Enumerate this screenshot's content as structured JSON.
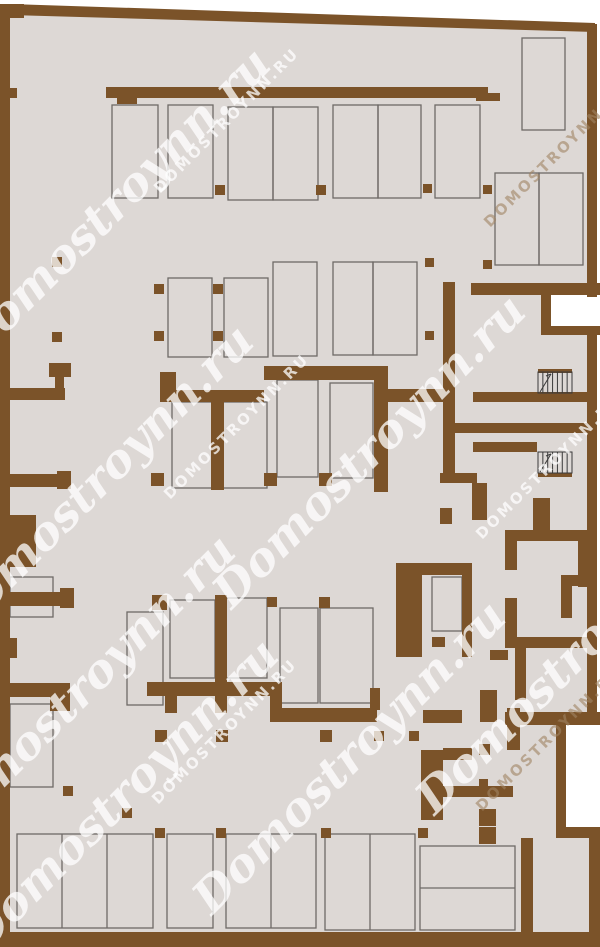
{
  "document": {
    "kind": "architectural-floor-plan",
    "watermark_script_text": "Domostroynn.ru",
    "watermark_caps_text": "DOMOSTROYNN.RU"
  },
  "colors": {
    "outside": "#ffffff",
    "floor": "#ddd8d5",
    "wall": "#7b5329",
    "parking_outline": "#6e6a67",
    "stair_line": "#3a3a3a",
    "watermark_white": "rgba(255,255,255,0.75)",
    "watermark_tan": "rgba(160,132,99,0.6)"
  },
  "plan": {
    "width": 600,
    "height": 947,
    "floor_poly": "10,8 592,27 592,940 10,940",
    "top_wall_poly": "10,4 595,23 595,32 10,15",
    "white_notches": [
      [
        551,
        295,
        49,
        31
      ],
      [
        566,
        725,
        34,
        102
      ]
    ],
    "walls": [
      [
        0,
        5,
        10,
        942
      ],
      [
        0,
        4,
        24,
        14
      ],
      [
        587,
        24,
        10,
        273
      ],
      [
        587,
        327,
        10,
        395
      ],
      [
        589,
        836,
        11,
        111
      ],
      [
        0,
        932,
        600,
        15
      ],
      [
        10,
        88,
        7,
        10
      ],
      [
        10,
        515,
        26,
        52
      ],
      [
        10,
        638,
        7,
        20
      ],
      [
        106,
        87,
        382,
        11
      ],
      [
        117,
        98,
        20,
        6
      ],
      [
        476,
        93,
        24,
        8
      ],
      [
        471,
        283,
        129,
        12
      ],
      [
        541,
        295,
        10,
        39
      ],
      [
        541,
        326,
        59,
        9
      ],
      [
        264,
        366,
        124,
        14
      ],
      [
        374,
        380,
        14,
        112
      ],
      [
        388,
        389,
        59,
        13
      ],
      [
        443,
        282,
        12,
        191
      ],
      [
        160,
        390,
        104,
        12
      ],
      [
        160,
        372,
        16,
        18
      ],
      [
        211,
        402,
        13,
        88
      ],
      [
        49,
        363,
        22,
        14
      ],
      [
        55,
        377,
        9,
        14
      ],
      [
        10,
        388,
        55,
        12
      ],
      [
        10,
        474,
        52,
        13
      ],
      [
        57,
        471,
        14,
        18
      ],
      [
        10,
        592,
        55,
        14
      ],
      [
        60,
        588,
        14,
        20
      ],
      [
        10,
        683,
        60,
        14
      ],
      [
        50,
        694,
        20,
        17
      ],
      [
        473,
        392,
        116,
        10
      ],
      [
        452,
        423,
        145,
        10
      ],
      [
        473,
        442,
        64,
        10
      ],
      [
        538,
        369,
        34,
        4
      ],
      [
        538,
        473,
        34,
        4
      ],
      [
        440,
        473,
        37,
        10
      ],
      [
        472,
        483,
        15,
        37
      ],
      [
        533,
        498,
        17,
        34
      ],
      [
        440,
        508,
        12,
        16
      ],
      [
        505,
        530,
        12,
        40
      ],
      [
        505,
        530,
        85,
        11
      ],
      [
        578,
        541,
        12,
        46
      ],
      [
        561,
        575,
        29,
        11
      ],
      [
        561,
        586,
        11,
        32
      ],
      [
        505,
        598,
        12,
        42
      ],
      [
        505,
        637,
        85,
        11
      ],
      [
        515,
        648,
        11,
        52
      ],
      [
        505,
        712,
        95,
        13
      ],
      [
        490,
        650,
        18,
        10
      ],
      [
        556,
        714,
        10,
        118
      ],
      [
        556,
        827,
        44,
        11
      ],
      [
        521,
        838,
        12,
        94
      ],
      [
        396,
        563,
        26,
        94
      ],
      [
        422,
        563,
        50,
        12
      ],
      [
        462,
        563,
        10,
        94
      ],
      [
        432,
        637,
        13,
        10
      ],
      [
        147,
        682,
        133,
        14
      ],
      [
        165,
        696,
        12,
        17
      ],
      [
        215,
        595,
        12,
        118
      ],
      [
        270,
        682,
        12,
        40
      ],
      [
        280,
        708,
        97,
        14
      ],
      [
        370,
        688,
        10,
        22
      ],
      [
        423,
        710,
        39,
        13
      ],
      [
        480,
        690,
        17,
        32
      ],
      [
        507,
        708,
        13,
        42
      ],
      [
        421,
        750,
        22,
        70
      ],
      [
        443,
        786,
        70,
        11
      ],
      [
        443,
        748,
        29,
        12
      ]
    ],
    "columns": [
      [
        215,
        185,
        10
      ],
      [
        316,
        185,
        10
      ],
      [
        423,
        184,
        9
      ],
      [
        483,
        185,
        9
      ],
      [
        52,
        257,
        10
      ],
      [
        52,
        332,
        10
      ],
      [
        154,
        284,
        10
      ],
      [
        154,
        331,
        10
      ],
      [
        213,
        284,
        10
      ],
      [
        213,
        331,
        10
      ],
      [
        425,
        258,
        9
      ],
      [
        425,
        331,
        9
      ],
      [
        483,
        260,
        9
      ],
      [
        151,
        473,
        13
      ],
      [
        264,
        473,
        13
      ],
      [
        319,
        473,
        13
      ],
      [
        152,
        595,
        15
      ],
      [
        267,
        597,
        10
      ],
      [
        319,
        597,
        11
      ],
      [
        63,
        786,
        10
      ],
      [
        122,
        808,
        10
      ],
      [
        155,
        730,
        12
      ],
      [
        216,
        730,
        12
      ],
      [
        320,
        730,
        12
      ],
      [
        374,
        731,
        10
      ],
      [
        409,
        731,
        10
      ],
      [
        155,
        828,
        10
      ],
      [
        216,
        828,
        10
      ],
      [
        321,
        828,
        10
      ],
      [
        418,
        828,
        10
      ],
      [
        479,
        744,
        11
      ],
      [
        479,
        779,
        9
      ],
      [
        479,
        809,
        17
      ],
      [
        479,
        827,
        17
      ]
    ],
    "parking_spaces": [
      [
        112,
        105,
        46,
        93
      ],
      [
        168,
        105,
        45,
        93
      ],
      [
        228,
        107,
        45,
        93
      ],
      [
        273,
        107,
        45,
        93
      ],
      [
        333,
        105,
        45,
        93
      ],
      [
        378,
        105,
        43,
        93
      ],
      [
        435,
        105,
        45,
        93
      ],
      [
        522,
        38,
        43,
        92
      ],
      [
        495,
        173,
        44,
        92
      ],
      [
        539,
        173,
        44,
        92
      ],
      [
        168,
        278,
        44,
        79
      ],
      [
        224,
        278,
        44,
        79
      ],
      [
        273,
        262,
        44,
        94
      ],
      [
        333,
        262,
        40,
        93
      ],
      [
        373,
        262,
        44,
        93
      ],
      [
        172,
        402,
        47,
        86
      ],
      [
        219,
        402,
        48,
        86
      ],
      [
        277,
        380,
        41,
        97
      ],
      [
        330,
        383,
        43,
        95
      ],
      [
        127,
        612,
        36,
        93
      ],
      [
        170,
        600,
        45,
        78
      ],
      [
        225,
        598,
        42,
        80
      ],
      [
        280,
        608,
        38,
        95
      ],
      [
        320,
        608,
        53,
        95
      ],
      [
        17,
        834,
        136,
        94
      ],
      [
        167,
        834,
        46,
        94
      ],
      [
        226,
        834,
        90,
        94
      ],
      [
        325,
        834,
        90,
        96
      ],
      [
        420,
        846,
        95,
        84
      ],
      [
        432,
        577,
        30,
        54
      ],
      [
        10,
        577,
        43,
        40
      ],
      [
        10,
        704,
        43,
        83
      ]
    ],
    "parking_dividers": [
      [
        62,
        834,
        62,
        928
      ],
      [
        107,
        834,
        107,
        928
      ],
      [
        271,
        834,
        271,
        928
      ],
      [
        370,
        834,
        370,
        930
      ],
      [
        420,
        888,
        515,
        888
      ]
    ],
    "stairs": [
      {
        "x": 538,
        "y": 372,
        "w": 34,
        "h": 21,
        "steps": 7
      },
      {
        "x": 538,
        "y": 452,
        "w": 34,
        "h": 21,
        "steps": 7
      }
    ],
    "watermarks": [
      {
        "kind": "script",
        "x": 125,
        "y": 215,
        "tone": "white"
      },
      {
        "kind": "script",
        "x": 108,
        "y": 492,
        "tone": "white"
      },
      {
        "kind": "script",
        "x": 380,
        "y": 462,
        "tone": "white"
      },
      {
        "kind": "script",
        "x": 90,
        "y": 702,
        "tone": "white"
      },
      {
        "kind": "script",
        "x": 133,
        "y": 806,
        "tone": "white"
      },
      {
        "kind": "script",
        "x": 360,
        "y": 768,
        "tone": "white"
      },
      {
        "kind": "script",
        "x": 583,
        "y": 668,
        "tone": "white"
      },
      {
        "kind": "caps",
        "x": 230,
        "y": 124,
        "tone": "white"
      },
      {
        "kind": "caps",
        "x": 560,
        "y": 158,
        "tone": "tan"
      },
      {
        "kind": "caps",
        "x": 240,
        "y": 430,
        "tone": "white"
      },
      {
        "kind": "caps",
        "x": 552,
        "y": 470,
        "tone": "white"
      },
      {
        "kind": "caps",
        "x": 228,
        "y": 735,
        "tone": "white"
      },
      {
        "kind": "caps",
        "x": 552,
        "y": 742,
        "tone": "tan"
      }
    ]
  }
}
